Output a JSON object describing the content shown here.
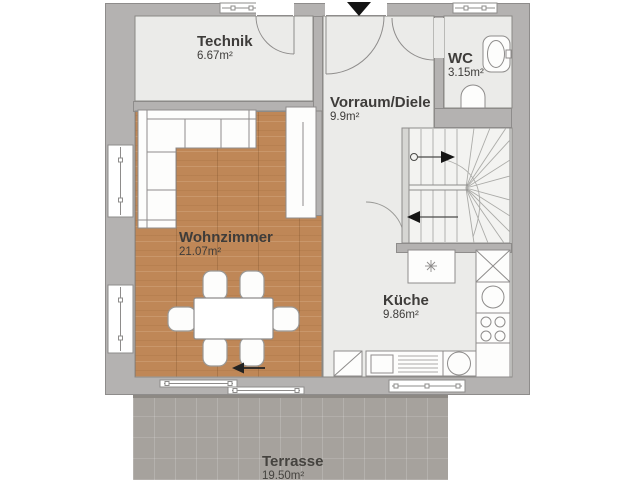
{
  "rooms": {
    "technik": {
      "name": "Technik",
      "area": "6.67m²"
    },
    "wc": {
      "name": "WC",
      "area": "3.15m²"
    },
    "vorraum": {
      "name": "Vorraum/Diele",
      "area": "9.9m²"
    },
    "wohnzimmer": {
      "name": "Wohnzimmer",
      "area": "21.07m²"
    },
    "kueche": {
      "name": "Küche",
      "area": "9.86m²"
    },
    "terrasse": {
      "name": "Terrasse",
      "area": "19.50m²"
    }
  },
  "fixtures": [
    "entry-arrow",
    "entry-door-swing",
    "technik-door-swing",
    "wc-door-swing",
    "staircase",
    "stair-up-arrow",
    "stair-down-arrow",
    "sofa",
    "sideboard",
    "dining-table",
    "dining-chairs",
    "terrace-direction-arrow",
    "kitchen-island",
    "tall-cabinet",
    "kitchen-sink",
    "cooktop",
    "dishwasher",
    "counter-sink",
    "washing-drum",
    "washbasin",
    "toilet",
    "window",
    "sliding-terrace-door"
  ],
  "colors": {
    "wall": "#b4b2b1",
    "wall_outline": "#8e8c8b",
    "room_floor": "#ebebe9",
    "wood_floor": "#bf8757",
    "terrace": "#a6a29d",
    "label_text": "#3e3c3a",
    "arrow": "#141414"
  }
}
